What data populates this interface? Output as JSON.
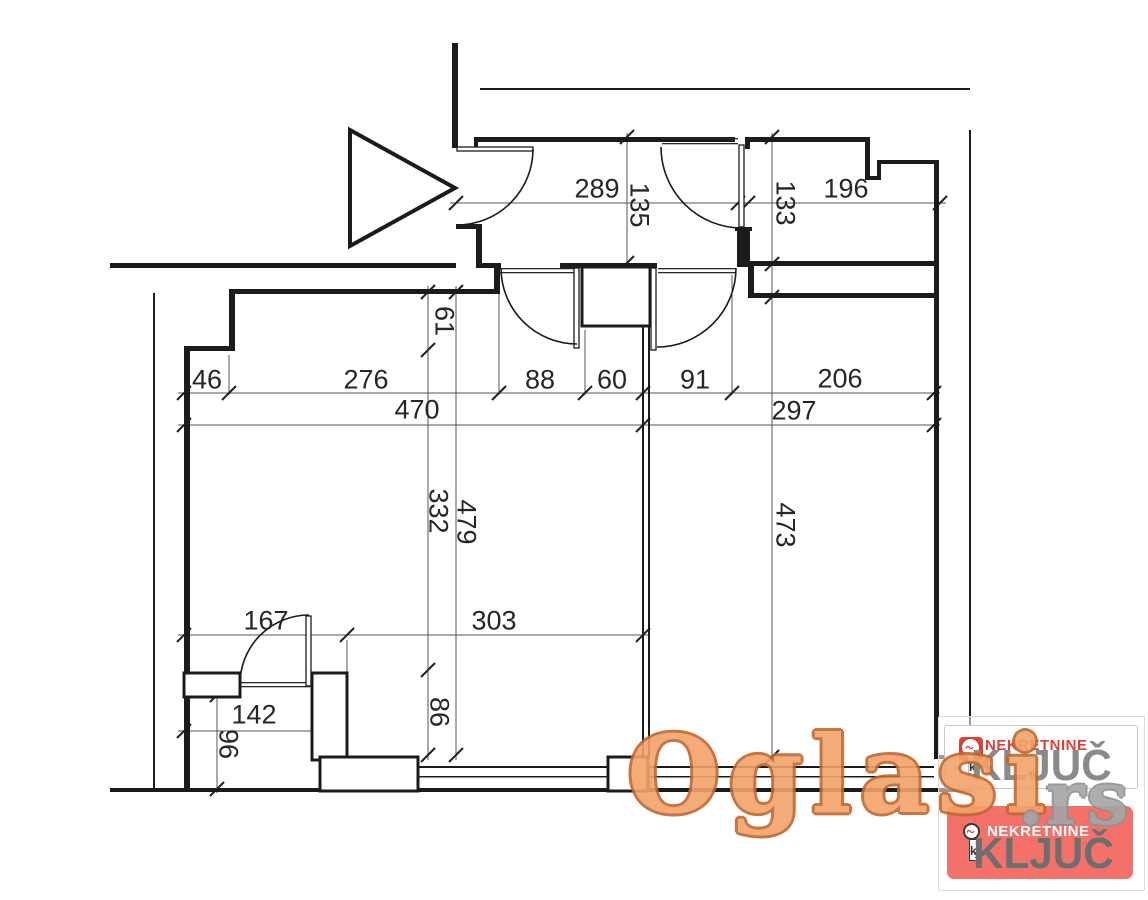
{
  "dims": {
    "d289": "289",
    "d135": "135",
    "d133": "133",
    "d196": "196",
    "d46": "46",
    "d276": "276",
    "d88": "88",
    "d60": "60",
    "d91": "91",
    "d206": "206",
    "d470": "470",
    "d297": "297",
    "d61": "61",
    "d332": "332",
    "d86": "86",
    "d479": "479",
    "d473": "473",
    "d167": "167",
    "d303": "303",
    "d142": "142",
    "d96": "96"
  },
  "watermark": {
    "text": "Oglasi",
    "suffix": ".rs"
  },
  "badges": {
    "primary": {
      "brand": "NEKRETNINE",
      "name": "KLJUČ"
    },
    "secondary": {
      "brand": "NEKRETNINE",
      "name": "KLJUČ"
    },
    "key_letter": "k"
  },
  "colors": {
    "plan_line": "#1B1B1B",
    "dimension_line": "#555555",
    "watermark_fill": "#F2A269",
    "watermark_outline": "#C2672F",
    "watermark_suffix": "#A5A5A5",
    "brand_red": "#DC4238",
    "card_pink": "#F4716A",
    "kljuc_gray": "#8A8A8A"
  }
}
